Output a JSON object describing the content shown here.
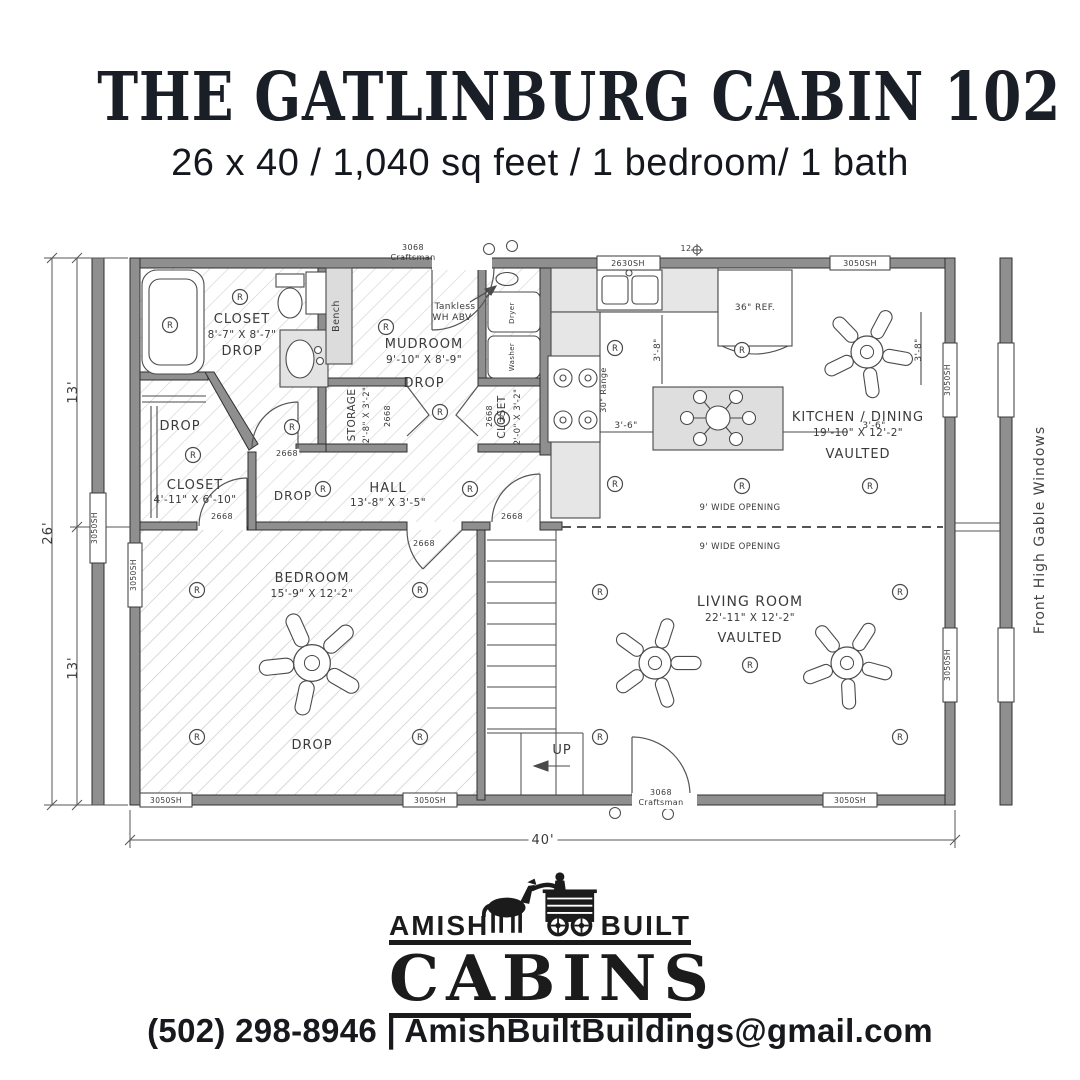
{
  "header": {
    "title": "THE GATLINBURG CABIN 102",
    "subtitle": "26 x 40 / 1,040 sq feet / 1 bedroom/ 1 bath"
  },
  "footer": {
    "amish": "AMISH",
    "built": "BUILT",
    "cabins": "CABINS",
    "contact": "(502) 298-8946 | AmishBuiltBuildings@gmail.com"
  },
  "plan": {
    "wall_color": "#8f8f8f",
    "line_color": "#4a4a4a",
    "recessed_symbol": "R",
    "side_note": "Front High Gable Windows",
    "recessed_lights": [
      [
        240,
        297
      ],
      [
        170,
        325
      ],
      [
        386,
        327
      ],
      [
        292,
        427
      ],
      [
        193,
        455
      ],
      [
        323,
        489
      ],
      [
        440,
        412
      ],
      [
        502,
        419
      ],
      [
        470,
        489
      ],
      [
        615,
        348
      ],
      [
        615,
        484
      ],
      [
        742,
        350
      ],
      [
        742,
        486
      ],
      [
        870,
        486
      ],
      [
        197,
        590
      ],
      [
        420,
        590
      ],
      [
        197,
        737
      ],
      [
        420,
        737
      ],
      [
        600,
        592
      ],
      [
        900,
        592
      ],
      [
        750,
        665
      ],
      [
        600,
        737
      ],
      [
        900,
        737
      ]
    ],
    "fans": [
      [
        867,
        352,
        47,
        10
      ],
      [
        312,
        663,
        54,
        30
      ],
      [
        655,
        663,
        47,
        0
      ],
      [
        847,
        663,
        47,
        15
      ]
    ],
    "door_gaps": [
      [
        432,
        256,
        60,
        14
      ],
      [
        632,
        793,
        65,
        14
      ]
    ],
    "windows": [
      [
        597,
        256,
        63,
        14
      ],
      [
        830,
        256,
        60,
        14
      ],
      [
        140,
        793,
        52,
        14
      ],
      [
        403,
        793,
        54,
        14
      ],
      [
        823,
        793,
        54,
        14
      ],
      [
        128,
        543,
        14,
        64
      ],
      [
        943,
        343,
        14,
        74
      ],
      [
        943,
        628,
        14,
        74
      ],
      [
        90,
        493,
        16,
        70
      ],
      [
        998,
        343,
        16,
        74
      ],
      [
        998,
        628,
        16,
        74
      ]
    ],
    "annotations": [
      {
        "x": 242,
        "y": 323,
        "t": "CLOSET",
        "s": 13
      },
      {
        "x": 242,
        "y": 338,
        "t": "8'-7\" X 8'-7\"",
        "s": 10.5
      },
      {
        "x": 242,
        "y": 355,
        "t": "DROP",
        "s": 13
      },
      {
        "x": 339,
        "y": 316,
        "t": "Bench",
        "s": 9.5,
        "r": -90
      },
      {
        "x": 424,
        "y": 348,
        "t": "MUDROOM",
        "s": 13
      },
      {
        "x": 424,
        "y": 363,
        "t": "9'-10\" X 8'-9\"",
        "s": 10.5
      },
      {
        "x": 424,
        "y": 387,
        "t": "DROP",
        "s": 13
      },
      {
        "x": 455,
        "y": 309,
        "t": "Tankless",
        "s": 9
      },
      {
        "x": 452,
        "y": 320,
        "t": "WH ABV",
        "s": 9
      },
      {
        "x": 355,
        "y": 415,
        "t": "STORAGE",
        "s": 10.5,
        "r": -90
      },
      {
        "x": 369,
        "y": 415,
        "t": "2'-8\" X 3'-2\"",
        "s": 8.5,
        "r": -90
      },
      {
        "x": 505,
        "y": 417,
        "t": "CLOSET",
        "s": 10.5,
        "r": -90
      },
      {
        "x": 520,
        "y": 417,
        "t": "2'-0\" X 3'-2\"",
        "s": 8.5,
        "r": -90
      },
      {
        "x": 180,
        "y": 430,
        "t": "DROP",
        "s": 13
      },
      {
        "x": 195,
        "y": 489,
        "t": "CLOSET",
        "s": 13
      },
      {
        "x": 195,
        "y": 503,
        "t": "4'-11\" X 6'-10\"",
        "s": 10.5
      },
      {
        "x": 388,
        "y": 492,
        "t": "HALL",
        "s": 13
      },
      {
        "x": 388,
        "y": 506,
        "t": "13'-8\" X 3'-5\"",
        "s": 10.5
      },
      {
        "x": 293,
        "y": 500,
        "t": "DROP",
        "s": 12
      },
      {
        "x": 312,
        "y": 582,
        "t": "BEDROOM",
        "s": 13
      },
      {
        "x": 312,
        "y": 597,
        "t": "15'-9\" X 12'-2\"",
        "s": 10.5
      },
      {
        "x": 312,
        "y": 749,
        "t": "DROP",
        "s": 13
      },
      {
        "x": 858,
        "y": 421,
        "t": "KITCHEN / DINING",
        "s": 13
      },
      {
        "x": 858,
        "y": 436,
        "t": "19'-10\" X 12'-2\"",
        "s": 10.5
      },
      {
        "x": 858,
        "y": 458,
        "t": "VAULTED",
        "s": 13
      },
      {
        "x": 750,
        "y": 606,
        "t": "LIVING ROOM",
        "s": 14
      },
      {
        "x": 750,
        "y": 621,
        "t": "22'-11\" X 12'-2\"",
        "s": 10.5
      },
      {
        "x": 750,
        "y": 642,
        "t": "VAULTED",
        "s": 13
      },
      {
        "x": 740,
        "y": 510,
        "t": "9' WIDE OPENING",
        "s": 8.5
      },
      {
        "x": 740,
        "y": 549,
        "t": "9' WIDE OPENING",
        "s": 8.5
      },
      {
        "x": 755,
        "y": 310,
        "t": "36\" REF.",
        "s": 9
      },
      {
        "x": 606,
        "y": 390,
        "t": "30\" Range",
        "s": 8,
        "r": -90
      },
      {
        "x": 514,
        "y": 357,
        "t": "Washer",
        "s": 7,
        "r": -90
      },
      {
        "x": 514,
        "y": 313,
        "t": "Dryer",
        "s": 7,
        "r": -90
      },
      {
        "x": 562,
        "y": 754,
        "t": "UP",
        "s": 13
      },
      {
        "x": 661,
        "y": 795,
        "t": "3068",
        "s": 8,
        "bg": 1
      },
      {
        "x": 661,
        "y": 805,
        "t": "Craftsman",
        "s": 8,
        "bg": 1
      },
      {
        "x": 413,
        "y": 250,
        "t": "3068",
        "s": 8
      },
      {
        "x": 413,
        "y": 260,
        "t": "Craftsman",
        "s": 8
      },
      {
        "x": 686,
        "y": 251,
        "t": "12",
        "s": 8
      },
      {
        "x": 77,
        "y": 392,
        "t": "13'",
        "s": 13,
        "r": -90,
        "n": "dim-left-top"
      },
      {
        "x": 52,
        "y": 533,
        "t": "26'",
        "s": 13,
        "r": -90,
        "n": "dim-left-total"
      },
      {
        "x": 77,
        "y": 668,
        "t": "13'",
        "s": 13,
        "r": -90,
        "n": "dim-left-bottom"
      },
      {
        "x": 543,
        "y": 844,
        "t": "40'",
        "s": 13,
        "bg": 1,
        "n": "dim-bottom"
      },
      {
        "x": 660,
        "y": 350,
        "t": "3'-8\"",
        "s": 9,
        "r": -90
      },
      {
        "x": 921,
        "y": 350,
        "t": "3'-8\"",
        "s": 9,
        "r": -90
      },
      {
        "x": 626,
        "y": 428,
        "t": "3'-6\"",
        "s": 9
      },
      {
        "x": 874,
        "y": 428,
        "t": "3'-6\"",
        "s": 9
      },
      {
        "x": 1044,
        "y": 530,
        "t": "Front High Gable Windows",
        "s": 14,
        "r": -90,
        "c": "#444444",
        "n": "side-note"
      },
      {
        "x": 628,
        "y": 266,
        "t": "2630SH",
        "s": 8
      },
      {
        "x": 860,
        "y": 266,
        "t": "3050SH",
        "s": 8
      },
      {
        "x": 166,
        "y": 803,
        "t": "3050SH",
        "s": 7.5
      },
      {
        "x": 430,
        "y": 803,
        "t": "3050SH",
        "s": 7.5
      },
      {
        "x": 850,
        "y": 803,
        "t": "3050SH",
        "s": 7.5
      },
      {
        "x": 136,
        "y": 575,
        "t": "3050SH",
        "s": 7.5,
        "r": -90
      },
      {
        "x": 950,
        "y": 380,
        "t": "3050SH",
        "s": 7.5,
        "r": -90
      },
      {
        "x": 950,
        "y": 665,
        "t": "3050SH",
        "s": 7.5,
        "r": -90
      },
      {
        "x": 97,
        "y": 528,
        "t": "3050SH",
        "s": 7.5,
        "r": -90
      },
      {
        "x": 287,
        "y": 456,
        "t": "2668",
        "s": 8,
        "bg": 1
      },
      {
        "x": 222,
        "y": 519,
        "t": "2668",
        "s": 8,
        "bg": 1
      },
      {
        "x": 424,
        "y": 546,
        "t": "2668",
        "s": 8,
        "bg": 1
      },
      {
        "x": 512,
        "y": 519,
        "t": "2668",
        "s": 8,
        "bg": 1
      },
      {
        "x": 390,
        "y": 416,
        "t": "2668",
        "s": 8,
        "r": -90
      },
      {
        "x": 492,
        "y": 416,
        "t": "2668",
        "s": 8,
        "r": -90
      }
    ]
  }
}
